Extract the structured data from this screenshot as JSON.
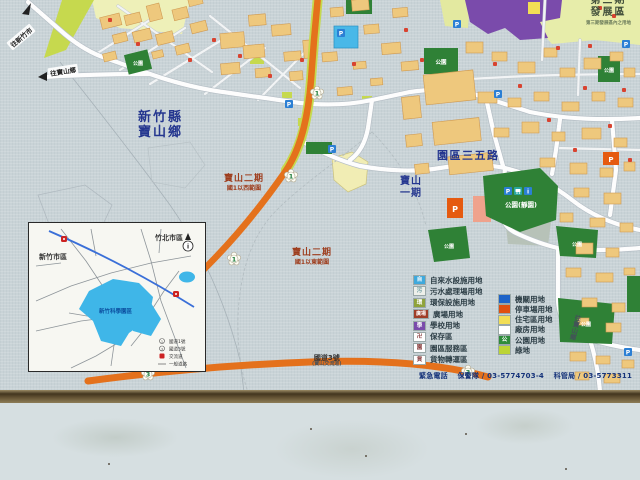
{
  "labels": {
    "county": "新竹縣",
    "township": "寶山鄉",
    "baoshan2_west": {
      "title": "寶山二期",
      "sub": "國1以西範圍"
    },
    "baoshan2_east": {
      "title": "寶山二期",
      "sub": "國1以東範圍"
    },
    "baoshan1": {
      "line1": "寶山",
      "line2": "一期"
    },
    "park_road_35": "園區三五路",
    "phase3": {
      "line1": "第三期",
      "line2": "發展區",
      "caption": "第三期發展區內之用地"
    },
    "to_hsinchu_city": "往新竹市",
    "to_baoshan_township": "往寶山鄉",
    "to_baoshan_township_right": "往寶山鄉",
    "highway3": {
      "name": "國道3號",
      "sub": "(寶山交流道)"
    },
    "shield_1": "1",
    "shield_3": "3"
  },
  "parks": [
    "公園",
    "公園",
    "公園(靜園)",
    "公園",
    "公園",
    "公園",
    "公園"
  ],
  "icons": {
    "parking_glyph": "P",
    "info_glyph": "i"
  },
  "legend": {
    "left": [
      {
        "char": "自",
        "label": "自來水設施用地",
        "color": "#3fa9dc"
      },
      {
        "char": "污",
        "label": "污水處理場用地",
        "color": "#eef0ea"
      },
      {
        "char": "環",
        "label": "環保設施用地",
        "color": "#8fa33a"
      },
      {
        "char": "廣場",
        "label": "廣場用地",
        "color": "#a03d28"
      },
      {
        "char": "學",
        "label": "學校用地",
        "color": "#7a4bab"
      },
      {
        "char": "卍",
        "label": "保存區",
        "color": "#ffffff"
      },
      {
        "char": "園",
        "label": "園區服務區",
        "color": "#ffffff"
      },
      {
        "char": "貨",
        "label": "貨物轉運區",
        "color": "#ffffff"
      }
    ],
    "right": [
      {
        "char": "",
        "label": "機關用地",
        "color": "#1e63c8"
      },
      {
        "char": "",
        "label": "停車場用地",
        "color": "#e05010"
      },
      {
        "char": "",
        "label": "住宅區用地",
        "color": "#f2de55"
      },
      {
        "char": "",
        "label": "廠房用地",
        "color": "#ffffff"
      },
      {
        "char": "公",
        "label": "公園用地",
        "color": "#2e8b3a"
      },
      {
        "char": "",
        "label": "綠地",
        "color": "#bcd435"
      }
    ]
  },
  "emergency": {
    "title": "緊急電話",
    "police": "保警隊 / 03-5774703-4",
    "bureau": "科管局 / 03-5773311"
  },
  "inset": {
    "zhubei": "竹北市區",
    "hsinchu": "新竹市區",
    "science_park": "新竹科學園區",
    "compass_glyph": "i",
    "legend": [
      {
        "label": "國道1號"
      },
      {
        "label": "國道3號"
      },
      {
        "label": "交流道"
      },
      {
        "label": "一般道路"
      }
    ]
  },
  "palette": {
    "map_bg": "#c9d3d7",
    "building": "#eec87d",
    "road": "#ffffff",
    "highway_orange": "#e4711c",
    "park_green": "#2f8136",
    "green_space": "#c6d94e",
    "school_purple": "#7a4bab",
    "development_zone": "#e7edaa",
    "water_blue": "#49b8e8",
    "parking_orange": "#e55a10"
  }
}
